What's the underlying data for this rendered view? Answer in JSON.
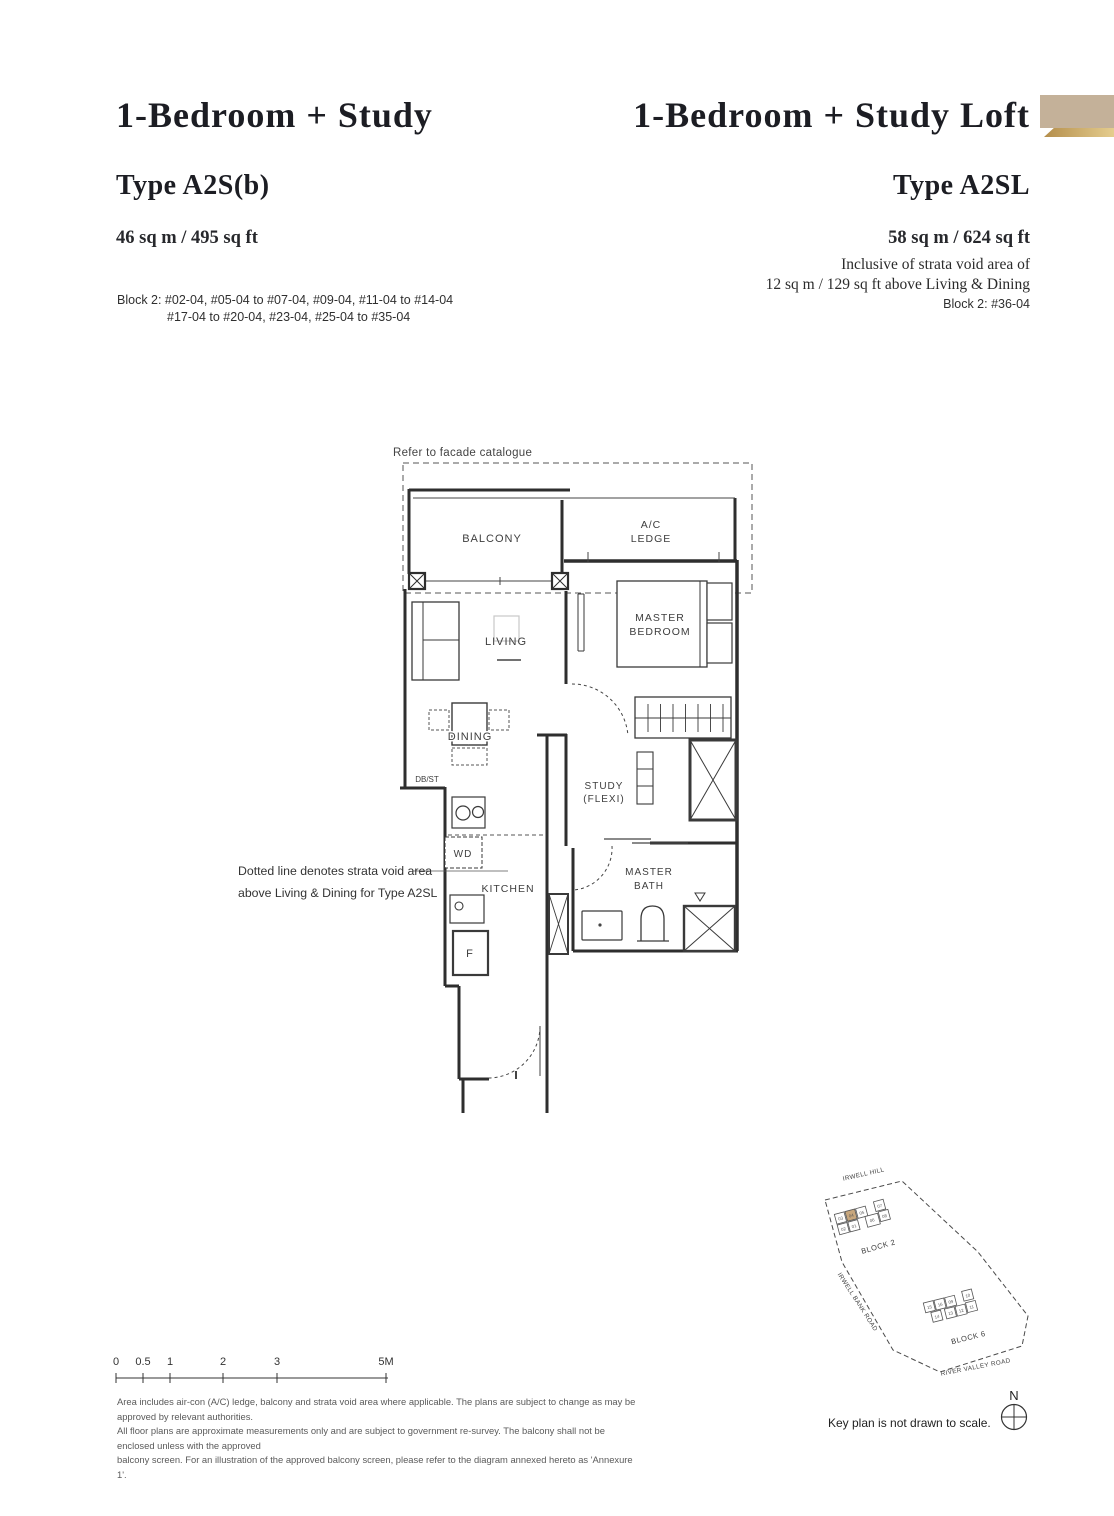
{
  "left_header": {
    "title": "1-Bedroom + Study",
    "type_label": "Type A2S(b)",
    "area": "46 sq m / 495 sq ft",
    "units_line1": "Block 2: #02-04, #05-04 to #07-04, #09-04, #11-04 to #14-04",
    "units_line2": "#17-04 to #20-04, #23-04, #25-04 to #35-04"
  },
  "right_header": {
    "title": "1-Bedroom + Study Loft",
    "type_label": "Type A2SL",
    "area": "58 sq m / 624 sq ft",
    "note_line1": "Inclusive of strata void area of",
    "note_line2": "12 sq m / 129 sq ft above Living & Dining",
    "units": "Block 2: #36-04"
  },
  "colors": {
    "tab_tan": "#c4b199",
    "tab_gold_dark": "#b48e4c",
    "tab_gold_light": "#e5cd8e",
    "keyplan_highlight": "#c8a77d"
  },
  "floor_plan": {
    "facade_note": "Refer to facade catalogue",
    "rooms": {
      "balcony": "BALCONY",
      "ac_ledge_line1": "A/C",
      "ac_ledge_line2": "LEDGE",
      "living": "LIVING",
      "master_bedroom_line1": "MASTER",
      "master_bedroom_line2": "BEDROOM",
      "dining": "DINING",
      "db_st": "DB/ST",
      "study_line1": "STUDY",
      "study_line2": "(FLEXI)",
      "wd": "WD",
      "kitchen": "KITCHEN",
      "master_bath_line1": "MASTER",
      "master_bath_line2": "BATH",
      "fridge": "F"
    },
    "annotation_line1": "Dotted line denotes strata void area",
    "annotation_line2": "above Living & Dining for Type A2SL"
  },
  "scale_bar": {
    "labels": [
      "0",
      "0.5",
      "1",
      "2",
      "3",
      "5M"
    ]
  },
  "disclaimer": {
    "line1": "Area includes air-con (A/C) ledge, balcony and strata void area where applicable. The plans are subject to change as may be approved by relevant authorities.",
    "line2": "All floor plans are approximate measurements only and are subject to government re-survey. The balcony shall not be enclosed unless with the approved",
    "line3": "balcony screen. For an illustration of the approved balcony screen, please refer to the diagram annexed hereto as 'Annexure 1'."
  },
  "key_plan": {
    "roads": {
      "irwell_hill": "IRWELL HILL",
      "irwell_bank_road": "IRWELL BANK ROAD",
      "river_valley_road": "RIVER VALLEY ROAD"
    },
    "block2_label": "BLOCK 2",
    "block6_label": "BLOCK 6",
    "block2_units": [
      "03",
      "04",
      "05",
      "07",
      "02",
      "01",
      "06",
      "08"
    ],
    "block6_units": [
      "15",
      "16",
      "09",
      "10",
      "14",
      "13",
      "12",
      "11"
    ],
    "north_label": "N",
    "note": "Key plan is not drawn to scale."
  }
}
